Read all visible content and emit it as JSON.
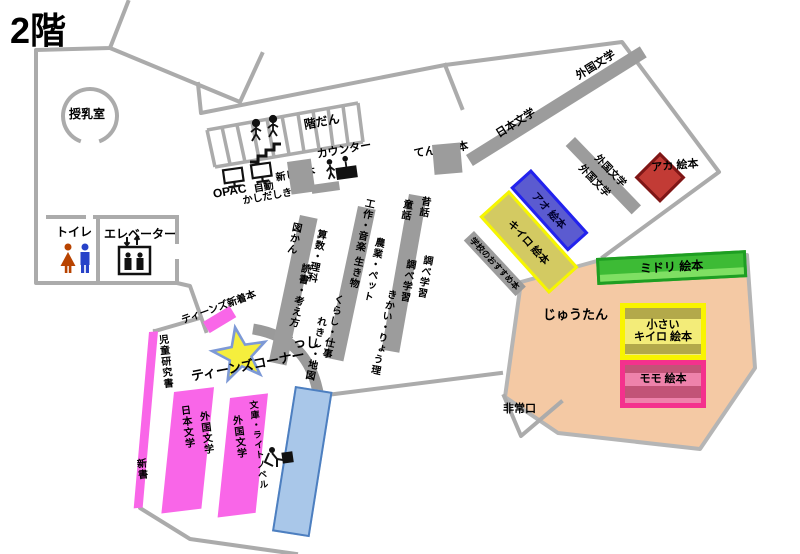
{
  "floor_title": "2階",
  "facilities": {
    "nursing_room": "授乳室",
    "toilet": "トイレ",
    "elevator": "エレベーター",
    "stairs": "階だん",
    "counter": "カウンター",
    "opac": "OPAC",
    "auto_checkout_line1": "自動",
    "auto_checkout_line2": "かしだしき",
    "new_books": "新しい本",
    "display_books": "てんじの本",
    "magazines": "ざっし",
    "emergency_exit": "非常口"
  },
  "general_shelves": {
    "japanese_literature": "日本文学",
    "foreign_literature": "外国文学",
    "foreign_literature_small_a": "外国文学",
    "foreign_literature_small_b": "外国文学"
  },
  "childrens_shelves": {
    "shelf1": [
      "図かん",
      "算数・理科",
      "読書・考え方",
      "くらし・仕事",
      "れきし・地図"
    ],
    "shelf2": [
      "工作・音楽",
      "生き物",
      "農業・ペット",
      "きかい・りょう理"
    ],
    "shelf3": [
      "童話",
      "昔話",
      "調べ学習",
      "調べ学習"
    ]
  },
  "picture_books": {
    "red": "アカ 絵本",
    "blue": "アオ 絵本",
    "yellow": "キイロ 絵本",
    "green": "ミドリ 絵本",
    "small_yellow_line1": "小さい",
    "small_yellow_line2": "キイロ 絵本",
    "peach": "モモ 絵本",
    "school_recommended": "学校のおすすめ本",
    "carpet": "じゅうたん"
  },
  "teens_area": {
    "corner_title": "ティーンズコーナー",
    "new_arrivals": "ティーンズ新着本",
    "research_books": "児童研究書",
    "paperback_pocket": "新書",
    "japanese_literature": "日本文学",
    "foreign_literature_a": "外国文学",
    "foreign_literature_b": "外国文学",
    "bunko_light_novel": "文庫・ライトノベル"
  },
  "colors": {
    "wall": "#ababab",
    "shelf_gray": "#9c9c9c",
    "teens_pink": "#f966e8",
    "carpet_peach": "#f4c9a4",
    "red_box": "#c23b35",
    "blue_box": "#5b5bd0",
    "yellow_box": "#d3ca62",
    "green_bar": "#3dbb35",
    "momo_pink": "#ee82ab",
    "desk_blue": "#a9c7e9",
    "star_yellow": "#f5ee3d",
    "star_blue": "#7d99d6"
  }
}
